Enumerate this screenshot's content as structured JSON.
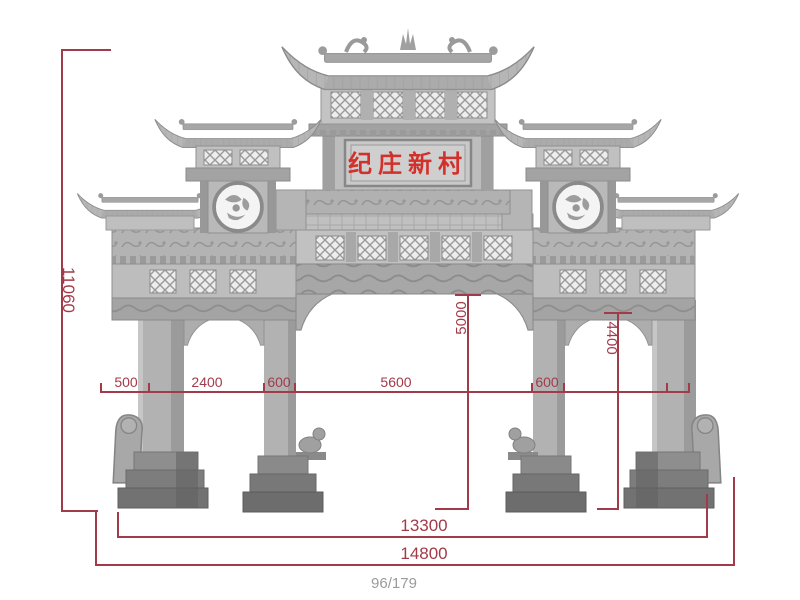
{
  "annotation_color": "#a23b49",
  "plaque": {
    "text": "纪庄新村",
    "color": "#d2302a"
  },
  "dims": {
    "height_total": "11060",
    "height_center_opening": "5000",
    "height_side_opening": "4400",
    "bottom_segments": [
      "500",
      "2400",
      "600",
      "5600",
      "600"
    ],
    "width_inner": "13300",
    "width_total": "14800"
  },
  "footer": {
    "counter": "96/179"
  }
}
